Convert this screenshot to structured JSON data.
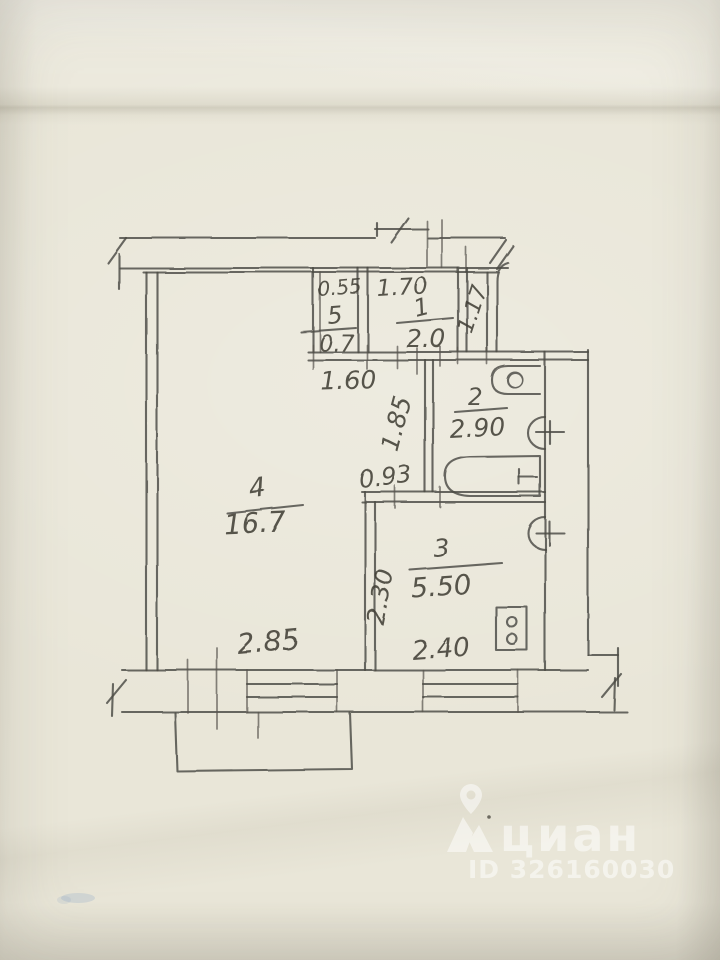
{
  "photo": {
    "paper_color": "#e9e6d8",
    "pencil_color": "#4b4943",
    "watermark_color": "#ffffff"
  },
  "plan": {
    "rooms": {
      "living": {
        "number": "4",
        "area": "16.7"
      },
      "kitchen": {
        "number": "3",
        "area": "5.50"
      },
      "bathroom": {
        "number": "2",
        "area": "2.90"
      },
      "hall": {
        "number": "1",
        "area": "2.0"
      },
      "closet": {
        "number": "5",
        "area": "0.7"
      }
    },
    "dimensions": {
      "closet_width": "0.55",
      "hall_width": "1.70",
      "entry_side": "1.17",
      "hall_bottom": "1.60",
      "corridor": "1.85",
      "passage": "0.93",
      "kitchen_side": "2.30",
      "kitchen_bottom": "2.40",
      "living_bottom": "2.85"
    },
    "fixtures": [
      "toilet",
      "wash-basin",
      "bathtub",
      "kitchen-sink",
      "stove"
    ]
  },
  "watermark": {
    "brand": "циан",
    "id_text": "ID 326160030"
  }
}
